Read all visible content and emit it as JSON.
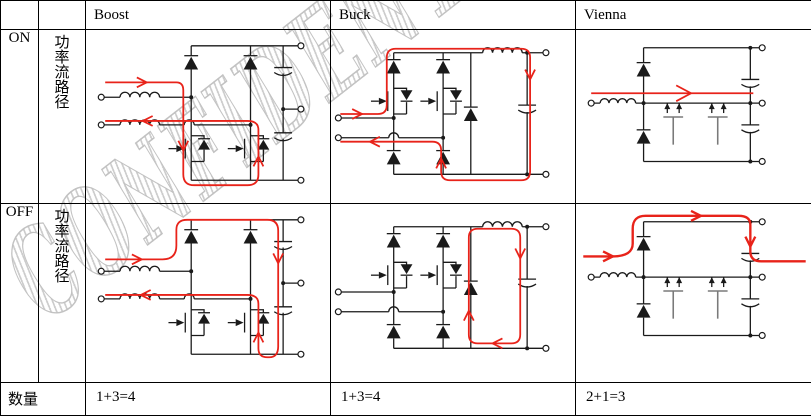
{
  "watermark": {
    "text": "CONFIDENTIAL"
  },
  "table": {
    "header": {
      "boost": "Boost",
      "buck": "Buck",
      "vienna": "Vienna"
    },
    "on": {
      "state": "ON",
      "path_label": [
        "功",
        "率",
        "流",
        "路",
        "径"
      ]
    },
    "off": {
      "state": "OFF",
      "path_label": [
        "功",
        "率",
        "流",
        "路",
        "径"
      ]
    },
    "quantity": {
      "label": "数量",
      "boost": "1+3=4",
      "buck": "1+3=4",
      "vienna": "2+1=3"
    }
  },
  "colors": {
    "trace_red": "#e8231a",
    "wire_black": "#1a1a1a",
    "watermark_gray": "#c9c9c9"
  }
}
